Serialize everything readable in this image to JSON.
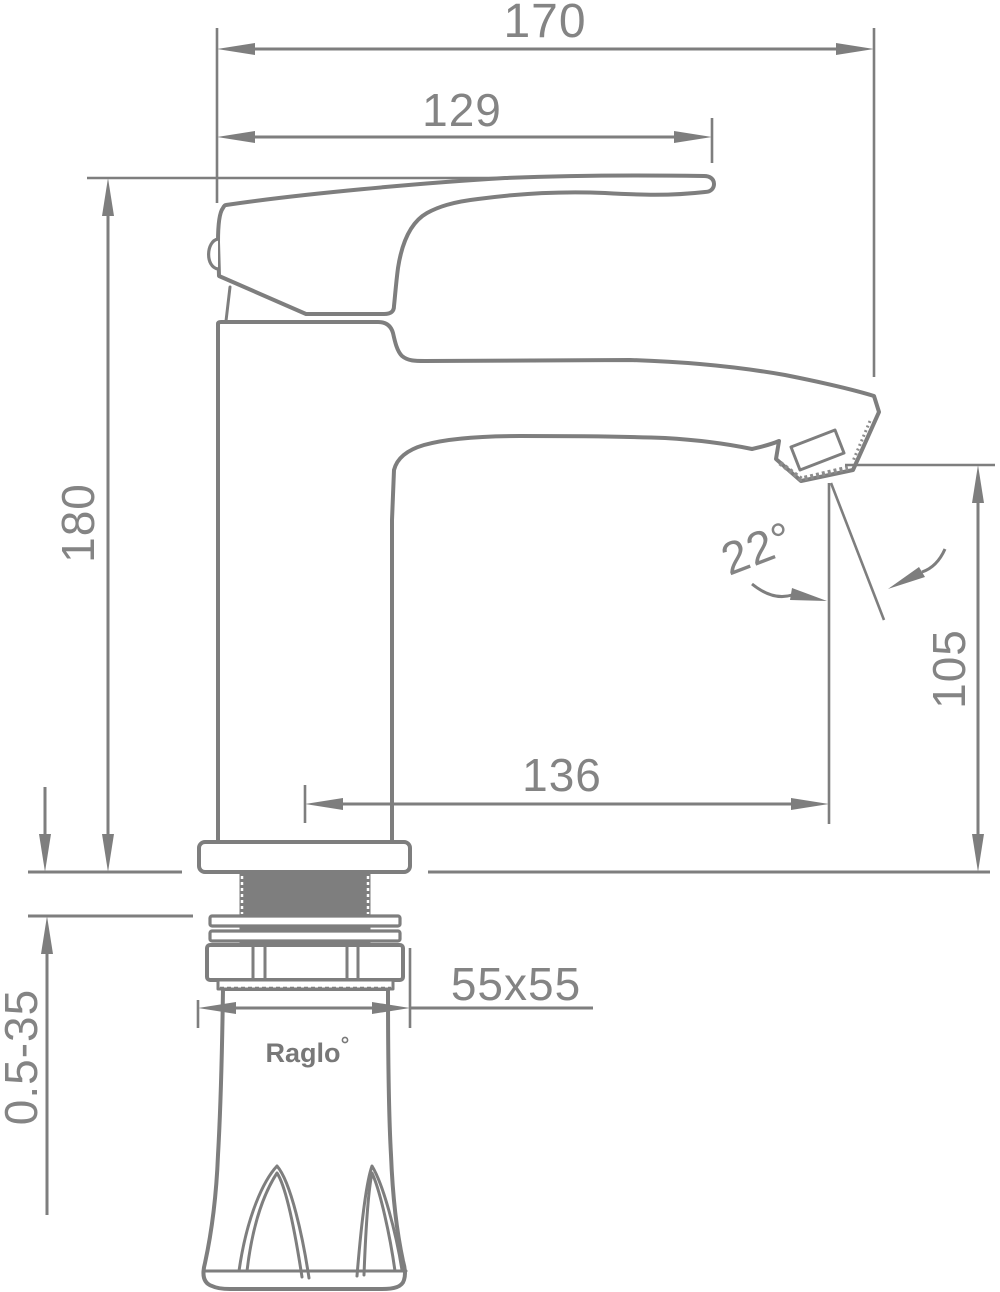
{
  "drawing": {
    "brand": "Raglo",
    "colors": {
      "line": "#7e7e7e",
      "text": "#848484",
      "background": "#ffffff"
    },
    "dimensions": {
      "overall_length": "170",
      "handle_length": "129",
      "overall_height": "180",
      "spout_reach": "136",
      "outlet_height": "105",
      "spout_angle": "22°",
      "base_plate": "55x55",
      "mount_thickness": "0.5-35"
    }
  }
}
